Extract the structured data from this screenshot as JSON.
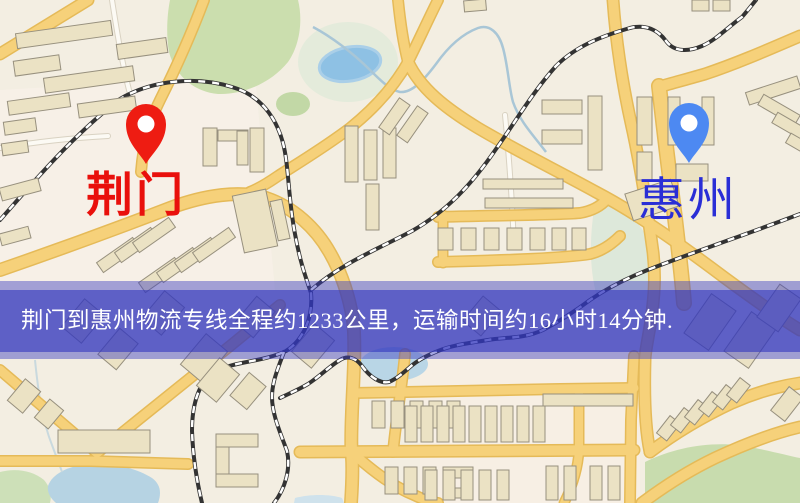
{
  "map": {
    "origin_label": "荆门",
    "destination_label": "惠州",
    "origin_marker": "red-pin",
    "destination_marker": "blue-pin"
  },
  "banner": {
    "text": "荆门到惠州物流专线全程约1233公里，运输时间约16小时14分钟."
  },
  "colors": {
    "origin_pin": "#ee1c12",
    "destination_pin": "#4d89f2",
    "origin_text": "#e9100c",
    "destination_text": "#2a2ed6",
    "banner_text": "#ffffff",
    "road_yellow": "#f6d17a",
    "water_blue": "#8ec1e4",
    "park_green": "#cbdeae",
    "map_background": "#f3eee2"
  }
}
